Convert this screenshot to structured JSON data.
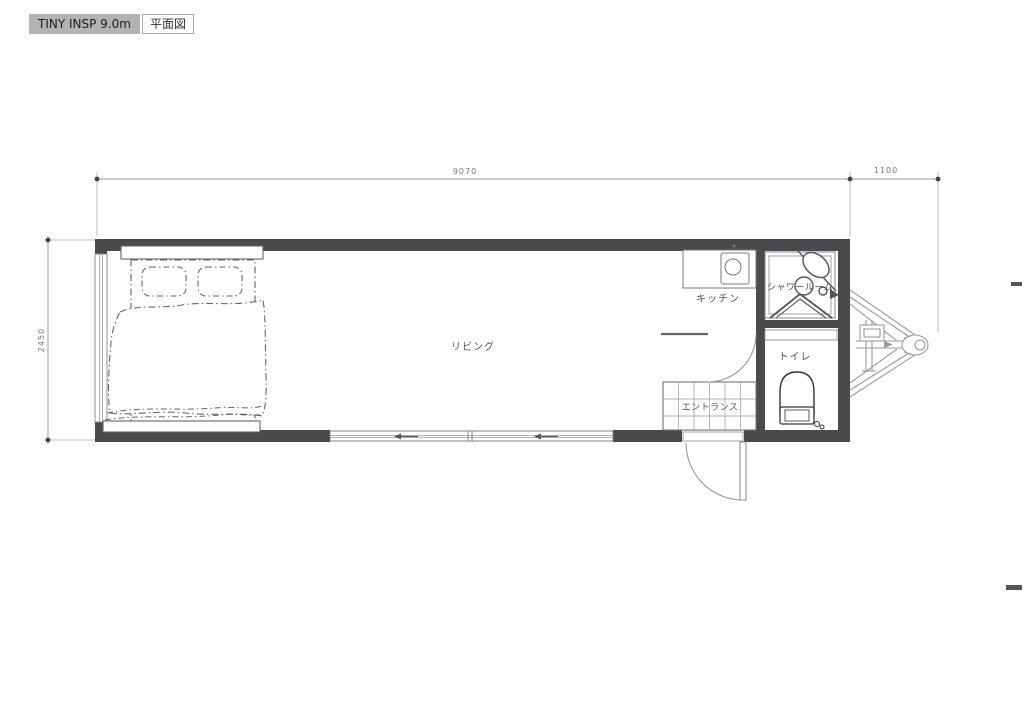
{
  "header": {
    "model_label": "TINY INSP 9.0m",
    "view_label": "平面図"
  },
  "dimensions": {
    "overall_length_mm": "9070",
    "hitch_length_mm": "1100",
    "overall_width_mm": "2450"
  },
  "rooms": {
    "living": "リビング",
    "kitchen": "キッチン",
    "shower_room": "シャワールーム",
    "toilet": "トイレ",
    "entrance": "エントランス"
  },
  "colors": {
    "wall": "#4a4a4c",
    "fixture_line": "#555555",
    "hitch_line": "#9a9a9a",
    "dimension_line": "#999999",
    "label_text": "#555555",
    "badge_bg": "#b3b3b3"
  }
}
